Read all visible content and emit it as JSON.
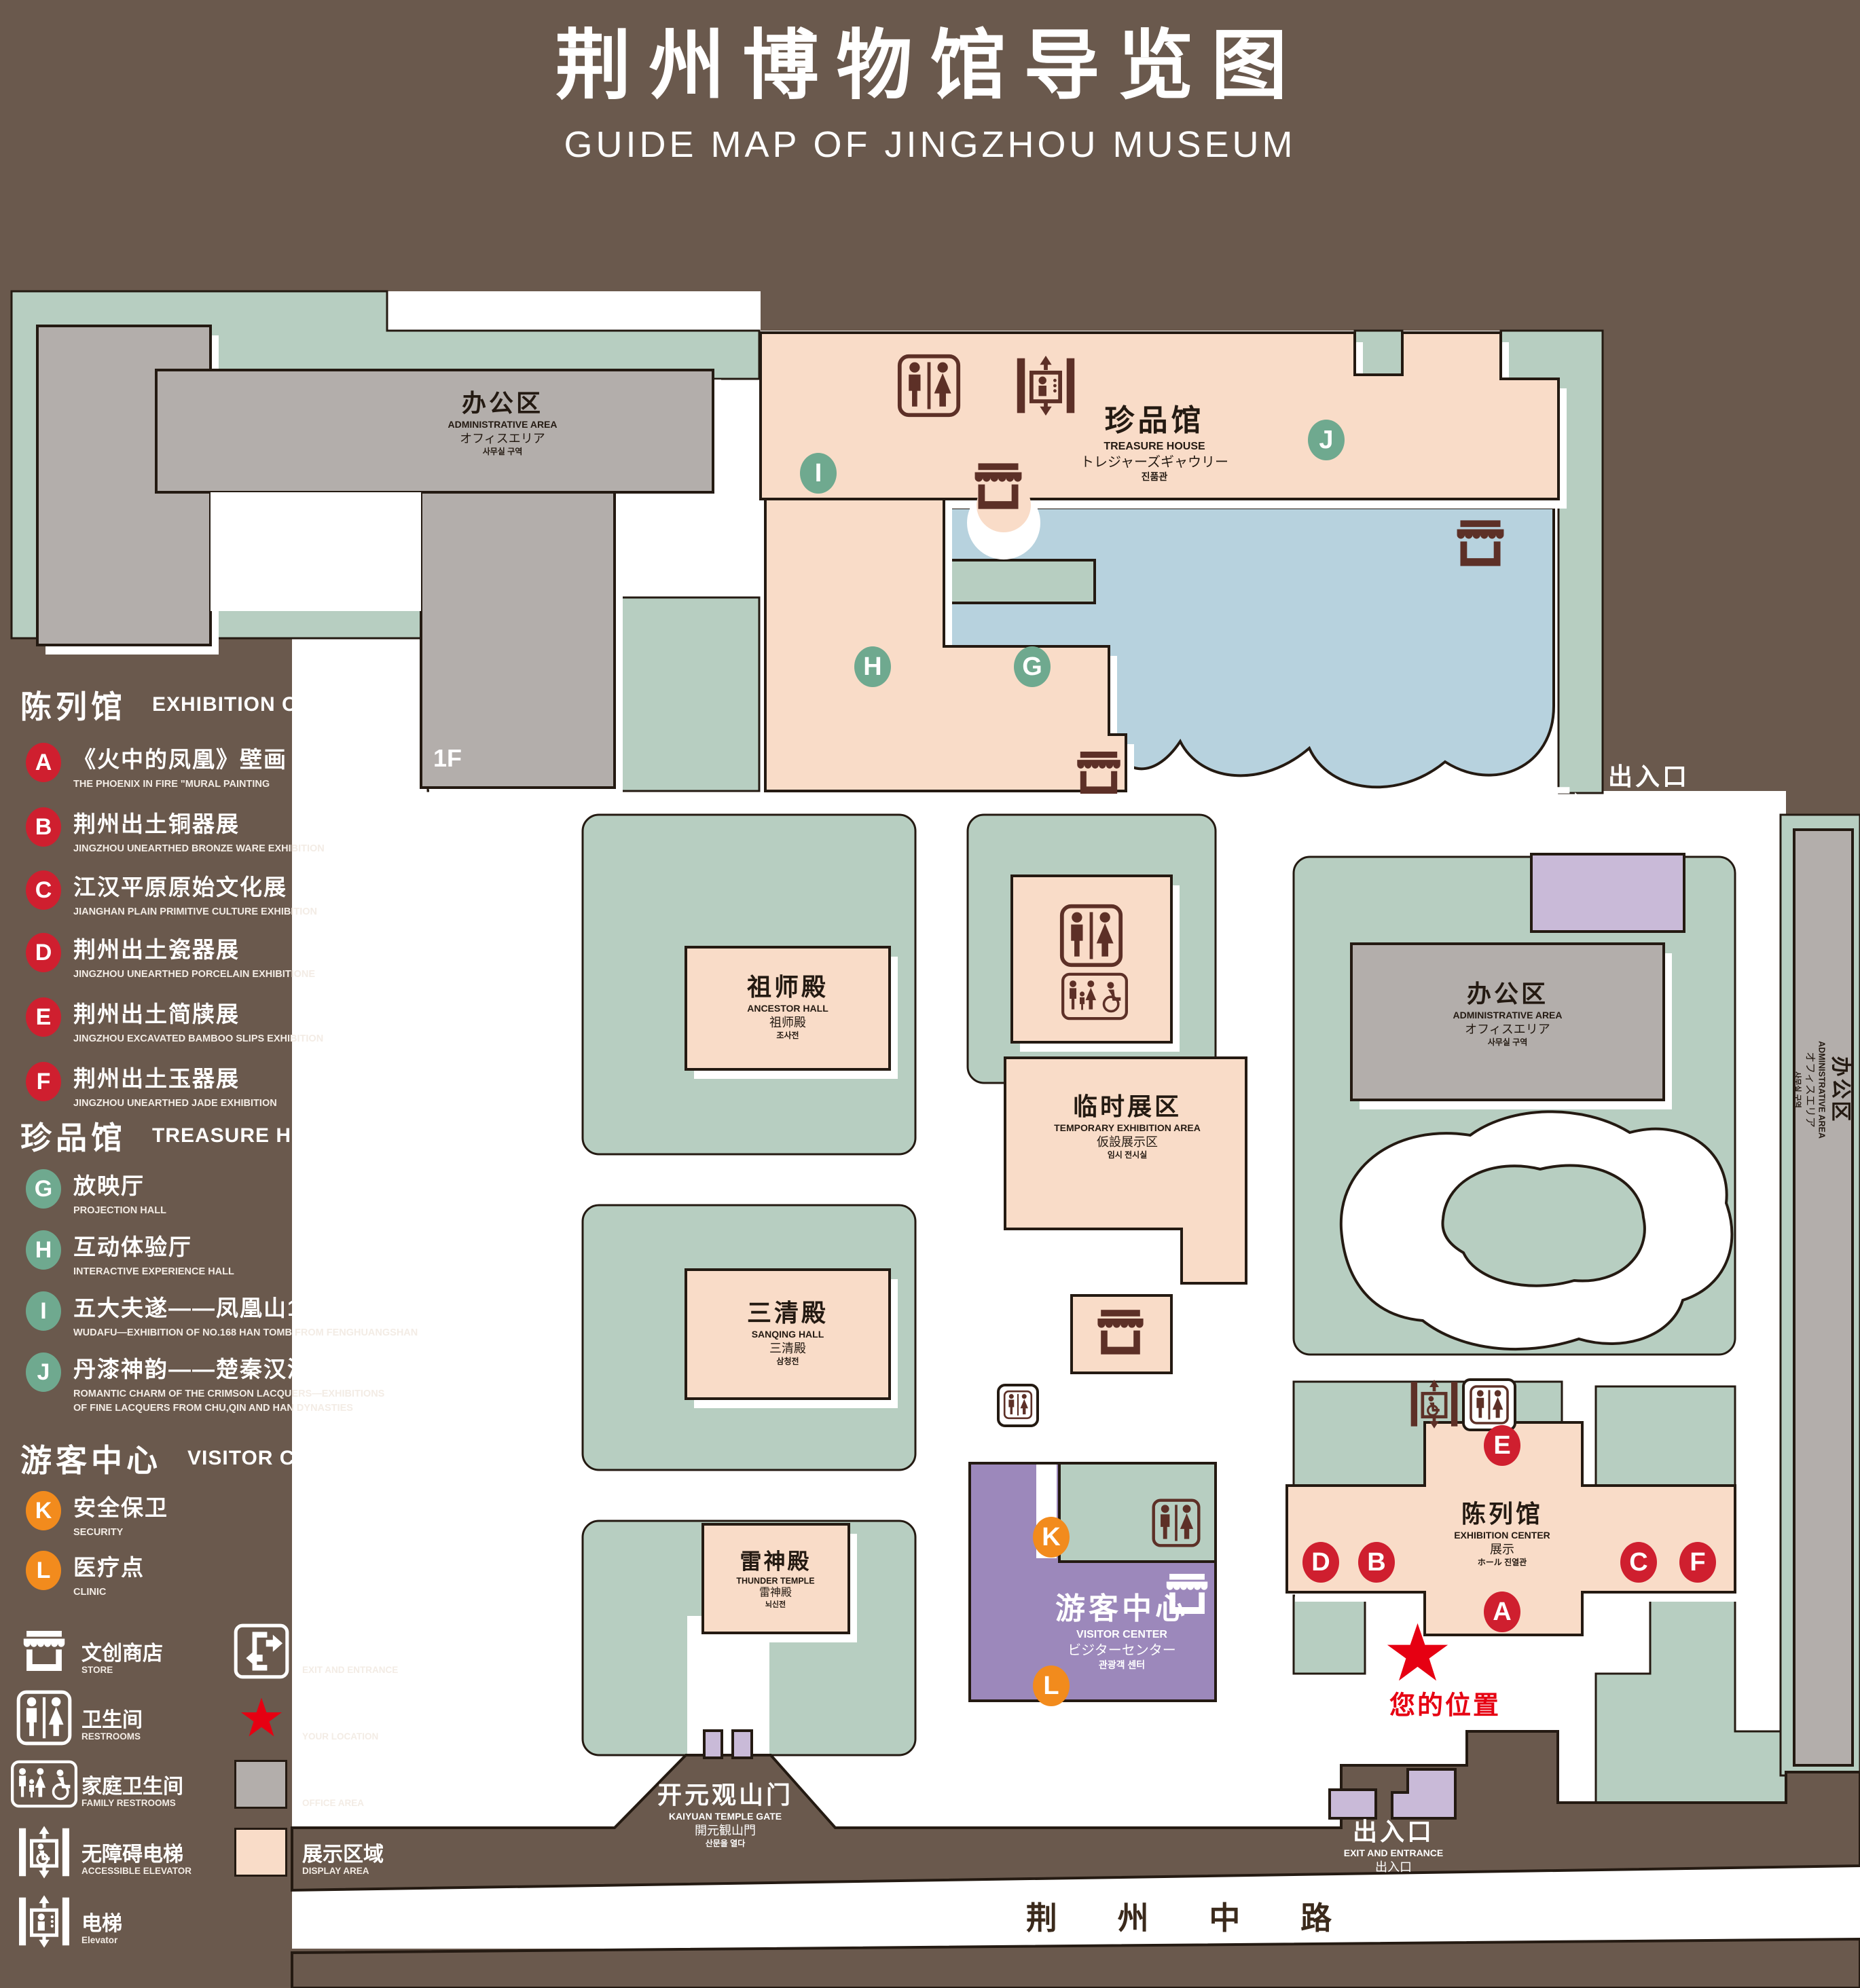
{
  "title": {
    "zh": "荆州博物馆导览图",
    "en": "GUIDE MAP OF JINGZHOU MUSEUM"
  },
  "legend": {
    "sections": [
      {
        "zh": "陈列馆",
        "en": "EXHIBITION CENTER",
        "items": [
          {
            "letter": "A",
            "zh": "《火中的凤凰》壁画",
            "en": "THE PHOENIX IN FIRE \"MURAL PAINTING",
            "floor": "1F"
          },
          {
            "letter": "B",
            "zh": "荆州出土铜器展",
            "en": "JINGZHOU UNEARTHED BRONZE WARE EXHIBITION",
            "floor": "1F"
          },
          {
            "letter": "C",
            "zh": "江汉平原原始文化展",
            "en": "JIANGHAN PLAIN PRIMITIVE CULTURE EXHIBITION",
            "floor": "1F"
          },
          {
            "letter": "D",
            "zh": "荆州出土瓷器展",
            "en": "JINGZHOU UNEARTHED PORCELAIN EXHIBITIONE",
            "floor": "2F"
          },
          {
            "letter": "E",
            "zh": "荆州出土简牍展",
            "en": "JINGZHOU EXCAVATED BAMBOO SLIPS EXHIBITION",
            "floor": "2F"
          },
          {
            "letter": "F",
            "zh": "荆州出土玉器展",
            "en": "JINGZHOU UNEARTHED JADE EXHIBITION",
            "floor": "2F"
          }
        ]
      },
      {
        "zh": "珍品馆",
        "en": "TREASURE HOUSE",
        "items": [
          {
            "letter": "G",
            "zh": "放映厅",
            "en": "PROJECTION HALL",
            "floor": "1F"
          },
          {
            "letter": "H",
            "zh": "互动体验厅",
            "en": "INTERACTIVE EXPERIENCE HALL",
            "floor": "1F"
          },
          {
            "letter": "I",
            "zh": "五大夫遂——凤凰山168号汉墓展",
            "en": "WUDAFU—EXHIBITION OF NO.168 HAN TOMB FROM FENGHUANGSHAN",
            "floor": "2F"
          },
          {
            "letter": "J",
            "zh": "丹漆神韵——楚秦汉漆器精品展",
            "en": "ROMANTIC CHARM OF THE CRIMSON LACQUERS—EXHIBITIONS\nOF FINE LACQUERS FROM CHU,QIN AND HAN DYNASTIES",
            "floor": "1-2F"
          }
        ]
      },
      {
        "zh": "游客中心",
        "en": "VISITOR CENTER",
        "items": [
          {
            "letter": "K",
            "zh": "安全保卫",
            "en": "SECURITY",
            "floor": "1F"
          },
          {
            "letter": "L",
            "zh": "医疗点",
            "en": "CLINIC",
            "floor": "1F"
          }
        ]
      }
    ],
    "footer": [
      {
        "zh": "文创商店",
        "en": "STORE"
      },
      {
        "zh": "出入口",
        "en": "EXIT AND ENTRANCE"
      },
      {
        "zh": "卫生间",
        "en": "RESTROOMS"
      },
      {
        "zh": "您的位置",
        "en": "YOUR LOCATION"
      },
      {
        "zh": "家庭卫生间",
        "en": "FAMILY RESTROOMS"
      },
      {
        "zh": "办公区域",
        "en": "OFFICE AREA"
      },
      {
        "zh": "无障碍电梯",
        "en": "ACCESSIBLE ELEVATOR"
      },
      {
        "zh": "展示区域",
        "en": "DISPLAY AREA"
      },
      {
        "zh": "电梯",
        "en": "Elevator"
      }
    ]
  },
  "map": {
    "admin": {
      "zh": "办公区",
      "en": "ADMINISTRATIVE AREA",
      "ja": "オフィスエリア",
      "ko": "사무실 구역"
    },
    "treasure": {
      "zh": "珍品馆",
      "en": "TREASURE HOUSE",
      "ja": "トレジャーズギャウリー",
      "ko": "진품관"
    },
    "ancestor": {
      "zh": "祖师殿",
      "en": "ANCESTOR HALL",
      "ja": "祖师殿",
      "ko": "조사전"
    },
    "sanqing": {
      "zh": "三清殿",
      "en": "SANQING HALL",
      "ja": "三清殿",
      "ko": "삼청전"
    },
    "thunder": {
      "zh": "雷神殿",
      "en": "THUNDER TEMPLE",
      "ja": "雷神殿",
      "ko": "뇌신전"
    },
    "temporary": {
      "zh": "临时展区",
      "en": "TEMPORARY EXHIBITION AREA",
      "ja": "仮設展示区",
      "ko": "임시 전시실"
    },
    "visitor": {
      "zh": "游客中心",
      "en": "VISITOR CENTER",
      "ja": "ビジターセンター",
      "ko": "관광객 센터"
    },
    "exhibition": {
      "zh": "陈列馆",
      "en": "EXHIBITION CENTER",
      "ja": "展示",
      "ko": "ホール 진열관"
    },
    "exit": {
      "zh": "出入口",
      "en": "EXIT AND ENTRANCE",
      "ja": "出入口",
      "ko": "출입구"
    },
    "gate": {
      "zh": "开元观山门",
      "en": "KAIYUAN TEMPLE GATE",
      "ja": "開元観山門",
      "ko": "산문을 열다"
    },
    "road": "荆 州 中 路",
    "your_location": "您的位置",
    "markers": [
      {
        "letter": "A",
        "color": "red"
      },
      {
        "letter": "B",
        "color": "red"
      },
      {
        "letter": "C",
        "color": "red"
      },
      {
        "letter": "D",
        "color": "red"
      },
      {
        "letter": "E",
        "color": "red"
      },
      {
        "letter": "F",
        "color": "red"
      },
      {
        "letter": "G",
        "color": "green"
      },
      {
        "letter": "H",
        "color": "green"
      },
      {
        "letter": "I",
        "color": "green"
      },
      {
        "letter": "J",
        "color": "green"
      },
      {
        "letter": "K",
        "color": "orange"
      },
      {
        "letter": "L",
        "color": "orange"
      }
    ]
  },
  "colors": {
    "background": "#6a594d",
    "green_area": "#b7cec1",
    "display_area": "#f9dcc8",
    "office_area": "#b3aeab",
    "visitor_center": "#9c88bb",
    "light_purple": "#c9bad8",
    "water": "#b7d2de",
    "marker_red": "#cf1f2f",
    "marker_green": "#6fa98f",
    "marker_orange": "#f28b1d",
    "icon_brown": "#5d3027",
    "star_red": "#e60012"
  }
}
